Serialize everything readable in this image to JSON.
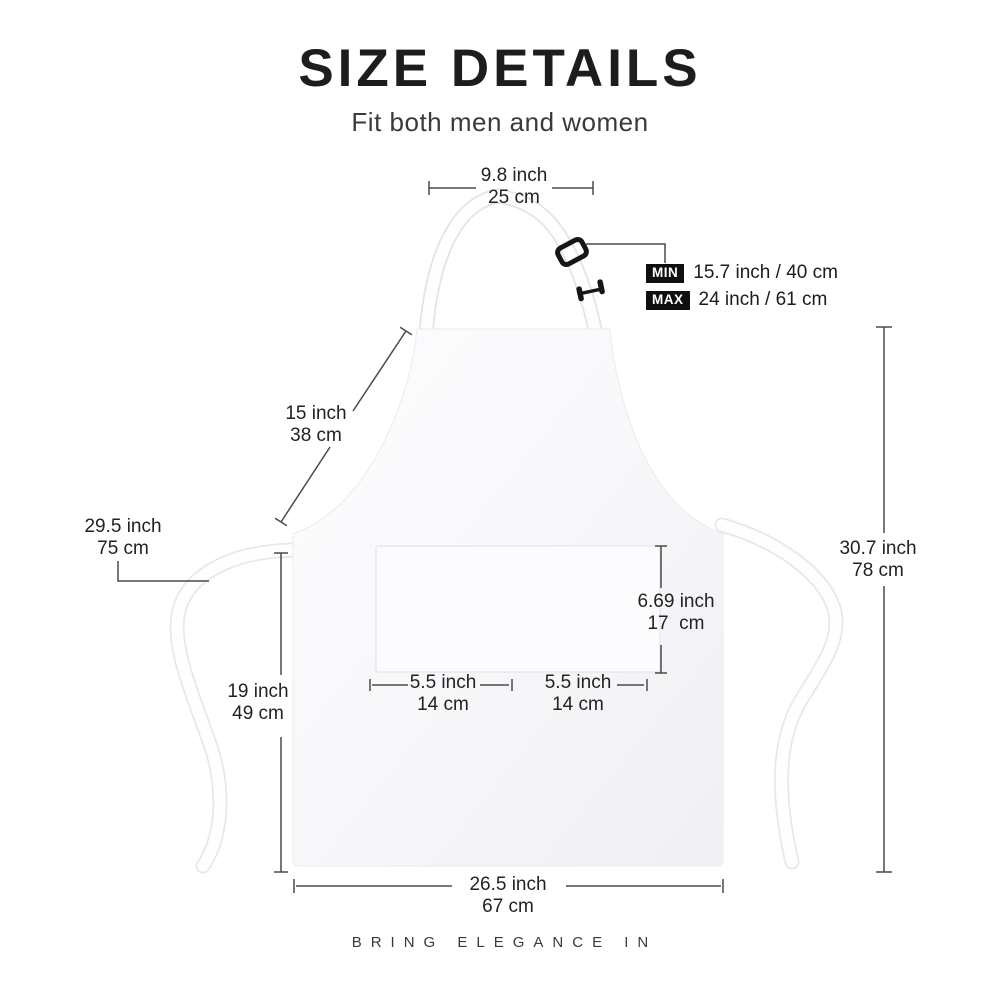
{
  "title": "SIZE DETAILS",
  "subtitle": "Fit both men and women",
  "footer": "BRING ELEGANCE IN",
  "colors": {
    "text": "#1f1f1f",
    "dim_line": "#4a4a4a",
    "badge_bg": "#0f0f0f",
    "badge_text": "#ffffff",
    "apron_fill": "#f5f5f8",
    "apron_edge": "#e9e9ee",
    "buckle": "#161616"
  },
  "dimensions": {
    "neck_width": {
      "inch": "9.8 inch",
      "cm": "25 cm"
    },
    "strap_min": {
      "badge": "MIN",
      "value": "15.7 inch / 40 cm"
    },
    "strap_max": {
      "badge": "MAX",
      "value": "24 inch / 61 cm"
    },
    "bib_height": {
      "inch": "15 inch",
      "cm": "38 cm"
    },
    "tie_length": {
      "inch": "29.5 inch",
      "cm": "75 cm"
    },
    "body_height": {
      "inch": "19 inch",
      "cm": "49 cm"
    },
    "pocket_height": {
      "inch": "6.69 inch",
      "cm": "17  cm"
    },
    "pocket_width_left": {
      "inch": "5.5 inch",
      "cm": "14 cm"
    },
    "pocket_width_right": {
      "inch": "5.5 inch",
      "cm": "14 cm"
    },
    "overall_height": {
      "inch": "30.7 inch",
      "cm": "78 cm"
    },
    "bottom_width": {
      "inch": "26.5 inch",
      "cm": "67 cm"
    }
  }
}
